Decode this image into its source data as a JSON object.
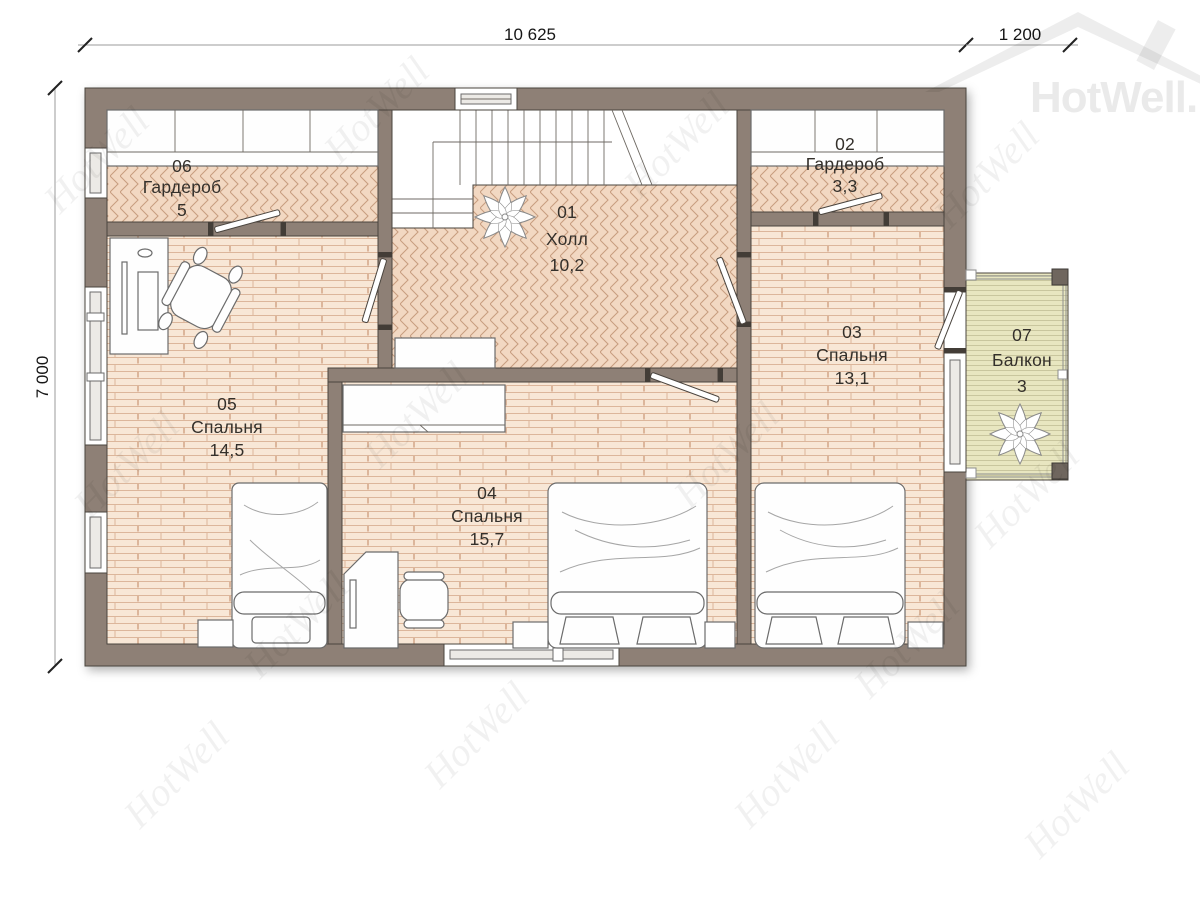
{
  "dimensions": {
    "width_total": "10 625",
    "balcony_width": "1 200",
    "height_total": "7 000"
  },
  "watermark": {
    "tile": "HotWell",
    "logo": "HotWell.KZ"
  },
  "rooms": [
    {
      "id": "01",
      "name": "Холл",
      "area": "10,2"
    },
    {
      "id": "02",
      "name": "Гардероб",
      "area": "3,3"
    },
    {
      "id": "03",
      "name": "Спальня",
      "area": "13,1"
    },
    {
      "id": "04",
      "name": "Спальня",
      "area": "15,7"
    },
    {
      "id": "05",
      "name": "Спальня",
      "area": "14,5"
    },
    {
      "id": "06",
      "name": "Гардероб",
      "area": "5"
    },
    {
      "id": "07",
      "name": "Балкон",
      "area": "3"
    }
  ],
  "colors": {
    "wall": "#8e8076",
    "outline": "#4a443e",
    "floor_parquet": "#f2d8c2",
    "floor_plank": "#f8e7d6",
    "floor_balcony": "#e8e6c0"
  }
}
